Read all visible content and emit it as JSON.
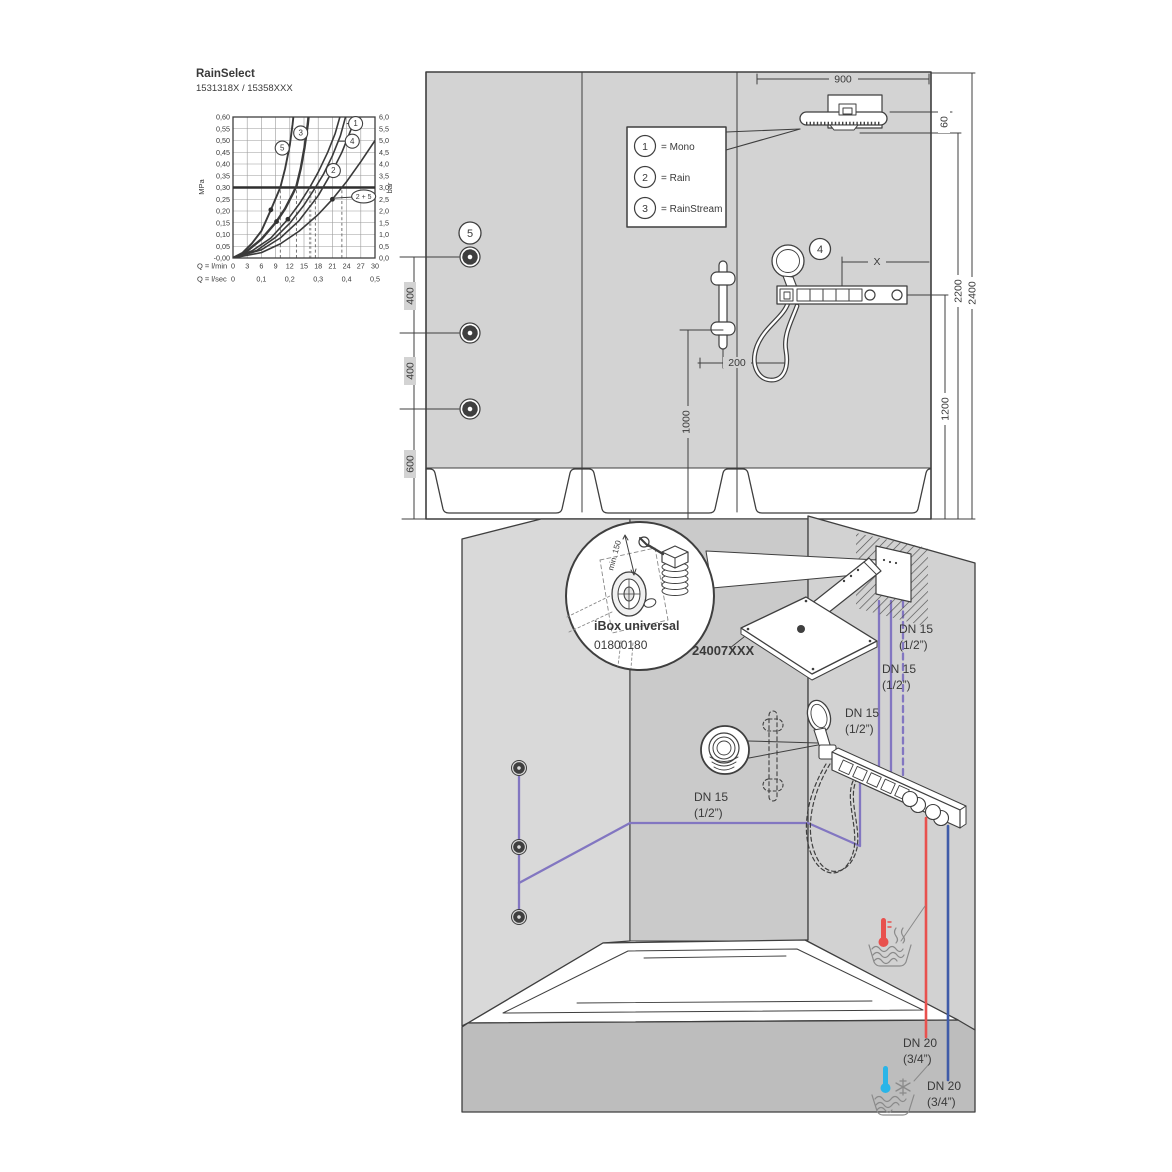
{
  "title": "RainSelect",
  "subtitle": "1531318X / 15358XXX",
  "chart": {
    "chart_data": {
      "type": "line",
      "title": "RainSelect",
      "subtitle": "1531318X / 15358XXX",
      "x_axis": {
        "label_primary": "Q = l/min",
        "ticks_primary": [
          0,
          3,
          6,
          9,
          12,
          15,
          18,
          21,
          24,
          27,
          30
        ],
        "label_secondary": "Q = l/sec",
        "ticks_secondary": [
          "0",
          "0,1",
          "0,2",
          "0,3",
          "0,4",
          "0,5"
        ],
        "range": [
          0,
          30
        ]
      },
      "y_axis_left": {
        "label": "MPa",
        "range": [
          0,
          0.6
        ],
        "step": 0.05
      },
      "y_axis_right": {
        "label": "bar",
        "range": [
          0,
          6.0
        ],
        "step": 0.5
      },
      "reference_line_mpa": 0.3,
      "grid": true,
      "series": [
        {
          "name": "5",
          "width": 1.9,
          "label_at": [
            10.4,
            0.468
          ],
          "points": [
            [
              0,
              0
            ],
            [
              2,
              0.022
            ],
            [
              4,
              0.062
            ],
            [
              6,
              0.115
            ],
            [
              8,
              0.205
            ],
            [
              10,
              0.3
            ],
            [
              11,
              0.38
            ],
            [
              12,
              0.48
            ],
            [
              12.6,
              0.57
            ],
            [
              12.9,
              0.63
            ]
          ]
        },
        {
          "name": "3",
          "width": 2.4,
          "label_at": [
            14.3,
            0.532
          ],
          "points": [
            [
              0,
              0
            ],
            [
              3,
              0.03
            ],
            [
              6,
              0.08
            ],
            [
              9.2,
              0.155
            ],
            [
              11,
              0.21
            ],
            [
              12.6,
              0.272
            ],
            [
              13.4,
              0.305
            ],
            [
              14.3,
              0.38
            ],
            [
              15.1,
              0.47
            ],
            [
              15.8,
              0.57
            ],
            [
              16.1,
              0.63
            ]
          ]
        },
        {
          "name": "4",
          "width": 1.6,
          "label_at": [
            25.2,
            0.497
          ],
          "leader_to": [
            22.2,
            0.497
          ],
          "points": [
            [
              0,
              0
            ],
            [
              4,
              0.03
            ],
            [
              8,
              0.085
            ],
            [
              11.6,
              0.165
            ],
            [
              14,
              0.23
            ],
            [
              16.2,
              0.3
            ],
            [
              18,
              0.365
            ],
            [
              20,
              0.45
            ],
            [
              21.6,
              0.53
            ],
            [
              23,
              0.63
            ]
          ]
        },
        {
          "name": "1",
          "width": 1.6,
          "label_at": [
            25.9,
            0.572
          ],
          "leader_to": [
            24,
            0.572
          ],
          "points": [
            [
              0,
              0
            ],
            [
              5,
              0.032
            ],
            [
              9,
              0.088
            ],
            [
              12,
              0.148
            ],
            [
              15,
              0.225
            ],
            [
              17.4,
              0.3
            ],
            [
              19.2,
              0.36
            ],
            [
              21,
              0.435
            ],
            [
              22.7,
              0.52
            ],
            [
              24.2,
              0.63
            ]
          ]
        },
        {
          "name": "2",
          "width": 1.6,
          "label_at": [
            21.2,
            0.372
          ],
          "points": [
            [
              0,
              0
            ],
            [
              6,
              0.035
            ],
            [
              10,
              0.085
            ],
            [
              14,
              0.16
            ],
            [
              18,
              0.265
            ],
            [
              21,
              0.37
            ],
            [
              23,
              0.45
            ],
            [
              25,
              0.55
            ],
            [
              26.2,
              0.63
            ]
          ]
        },
        {
          "name": "2 + 5",
          "width": 1.6,
          "label_shape": "ellipse",
          "label_at": [
            27.6,
            0.262
          ],
          "leader_to": [
            21.5,
            0.255
          ],
          "points": [
            [
              0,
              0
            ],
            [
              6,
              0.023
            ],
            [
              10,
              0.06
            ],
            [
              14,
              0.115
            ],
            [
              18,
              0.185
            ],
            [
              21,
              0.25
            ],
            [
              24,
              0.325
            ],
            [
              27,
              0.41
            ],
            [
              30,
              0.5
            ]
          ]
        }
      ],
      "markers": [
        [
          8,
          0.205
        ],
        [
          9.2,
          0.155
        ],
        [
          11.6,
          0.165
        ],
        [
          21,
          0.25
        ]
      ],
      "dashed_guides_x": [
        {
          "x": 10
        },
        {
          "x": 13.4
        },
        {
          "x": 16.3,
          "bold": true
        },
        {
          "x": 17.4
        },
        {
          "x": 23
        }
      ]
    }
  },
  "legend": {
    "rows": [
      {
        "num": "1",
        "label": "= Mono"
      },
      {
        "num": "2",
        "label": "= Rain"
      },
      {
        "num": "3",
        "label": "= RainStream"
      }
    ]
  },
  "elevation": {
    "dim_900": "900",
    "dim_60": "60",
    "dim_2200": "2200",
    "dim_2400": "2400",
    "dim_1200": "1200",
    "dim_400a": "400",
    "dim_400b": "400",
    "dim_600": "600",
    "dim_200": "200",
    "dim_1000": "1000",
    "dim_x": "X",
    "marker_4": "4",
    "marker_5": "5"
  },
  "iso": {
    "ibox_title": "iBox universal",
    "ibox_code": "01800180",
    "min_clearance": "min. 150",
    "product_code": "24007XXX",
    "dn15_line1": "DN 15",
    "dn15_line2": "(1/2”)",
    "dn20_line1": "DN 20",
    "dn20_line2": "(3/4”)"
  },
  "colors": {
    "wall": "#d3d3d3",
    "line": "#3f3f3f",
    "pipe_purple": "#8276c1",
    "pipe_hot": "#e8514e",
    "pipe_cold": "#3f5ba8",
    "cold_accent": "#2ab5e8",
    "muted": "#9a9a9a"
  }
}
